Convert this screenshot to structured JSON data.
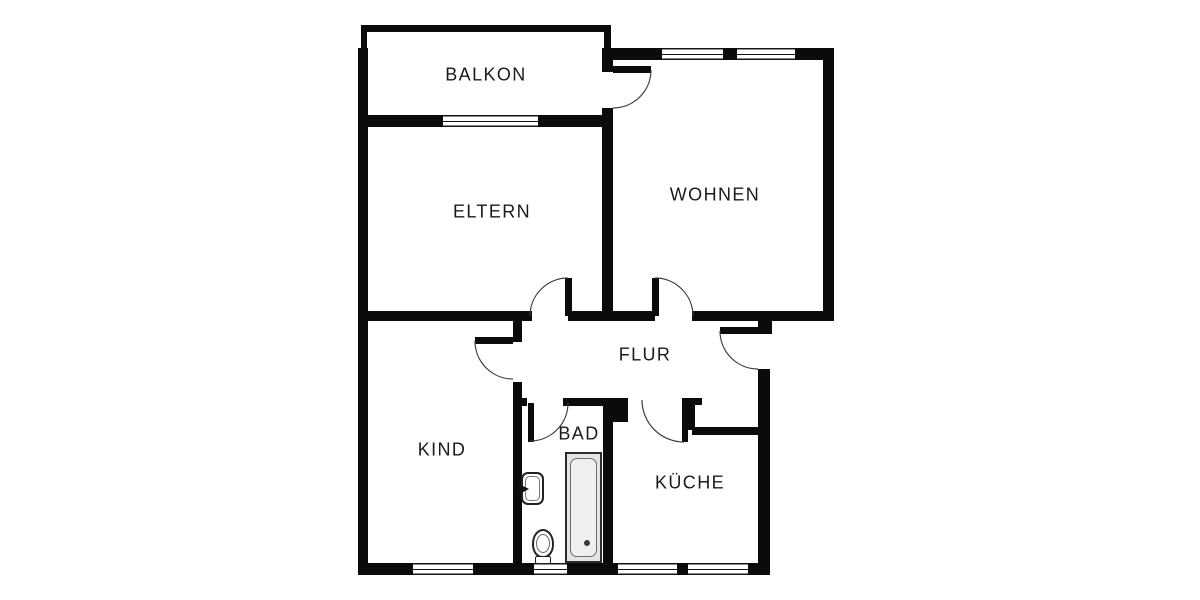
{
  "canvas": {
    "width": 1200,
    "height": 600,
    "background": "#ffffff"
  },
  "palette": {
    "wall": "#0b0b0b",
    "door_arc": "#3a3a3a",
    "tub_fill": "#e4e4e4",
    "text": "#1a1a1a"
  },
  "rooms": [
    {
      "id": "balkon",
      "label": "BALKON"
    },
    {
      "id": "eltern",
      "label": "ELTERN"
    },
    {
      "id": "wohnen",
      "label": "WOHNEN"
    },
    {
      "id": "flur",
      "label": "FLUR"
    },
    {
      "id": "kind",
      "label": "KIND"
    },
    {
      "id": "bad",
      "label": "BAD"
    },
    {
      "id": "kueche",
      "label": "KÜCHE"
    }
  ],
  "doors": [
    {
      "id": "door-balkon",
      "between": "wohnen-balkon"
    },
    {
      "id": "door-eltern",
      "between": "flur-eltern"
    },
    {
      "id": "door-wohnen",
      "between": "flur-wohnen"
    },
    {
      "id": "door-entrance",
      "between": "flur-outside"
    },
    {
      "id": "door-kind",
      "between": "flur-kind"
    },
    {
      "id": "door-bad",
      "between": "flur-bad"
    },
    {
      "id": "door-kueche",
      "between": "flur-kueche"
    }
  ],
  "windows": [
    {
      "id": "window-balkon-wall"
    },
    {
      "id": "window-wohnen-left"
    },
    {
      "id": "window-wohnen-right"
    },
    {
      "id": "window-kind"
    },
    {
      "id": "window-bad"
    },
    {
      "id": "window-kueche-left"
    },
    {
      "id": "window-kueche-right"
    }
  ],
  "fixtures": [
    {
      "id": "bathtub",
      "room": "bad"
    },
    {
      "id": "washbasin",
      "room": "bad"
    },
    {
      "id": "toilet",
      "room": "bad"
    }
  ]
}
